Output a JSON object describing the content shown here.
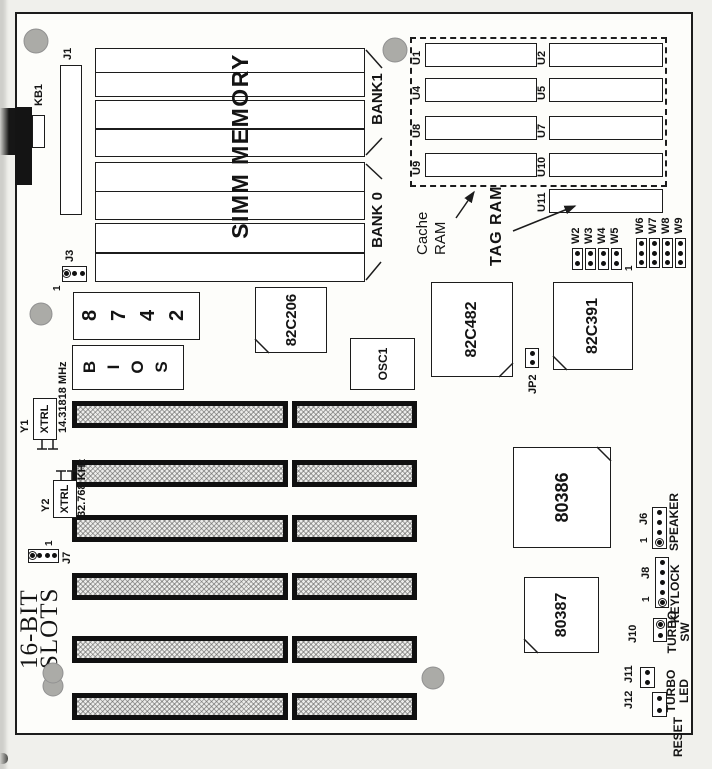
{
  "page": {
    "background": "#f0f0ec",
    "board_fill": "#fdfdfa",
    "line_color": "#1c1c1c",
    "hole_color": "#ababa7"
  },
  "diagram": {
    "slots_title_line1": "16-BIT",
    "slots_title_line2": "SLOTS",
    "slot_count": 6,
    "memory": {
      "heading": "SIMM MEMORY",
      "bank1_label": "BANK1",
      "bank0_label": "BANK 0",
      "socket_count": 4
    },
    "keyboard_label": "KB1",
    "connectors": {
      "j1": {
        "label": "J1",
        "pin_count": 14
      },
      "j3": {
        "label": "J3",
        "pin1": "1"
      },
      "j7": {
        "label": "J7",
        "pin1": "1"
      },
      "jp2": {
        "label": "JP2"
      },
      "j6": {
        "label": "J6",
        "pin1": "1",
        "function": "SPEAKER"
      },
      "j8": {
        "label": "J8",
        "pin1": "1",
        "function": "KEYLOCK"
      },
      "j10": {
        "label": "J10",
        "function_line1": "TURBO",
        "function_line2": "SW"
      },
      "j11": {
        "label": "J11"
      },
      "j12": {
        "label": "J12",
        "function_line1": "TURBO",
        "function_line2": "LED"
      },
      "reset_label": "RESET"
    },
    "crystals": {
      "y1": {
        "ref": "Y1",
        "part": "XTRL",
        "freq": "14.31818 MHz"
      },
      "y2": {
        "ref": "Y2",
        "part": "XTRL",
        "freq": "32.768 KHz"
      }
    },
    "chips": {
      "kbc": "8742",
      "bios": "BIOS",
      "c206": "82C206",
      "osc": "OSC1",
      "c482": "82C482",
      "c391": "82C391",
      "cpu": "80386",
      "fpu": "80387"
    },
    "cache": {
      "callout_line1": "Cache",
      "callout_line2": "RAM",
      "tag_callout": "TAG RAM",
      "row_top": [
        "U9",
        "U8",
        "U4",
        "U1"
      ],
      "row_bottom": [
        "U10",
        "U7",
        "U5",
        "U2"
      ],
      "tag_chip": "U11"
    },
    "jumpers": {
      "pin1": "1",
      "two_pin": [
        "W2",
        "W3",
        "W4",
        "W5"
      ],
      "three_pin": [
        "W6",
        "W7",
        "W8",
        "W9"
      ]
    }
  }
}
